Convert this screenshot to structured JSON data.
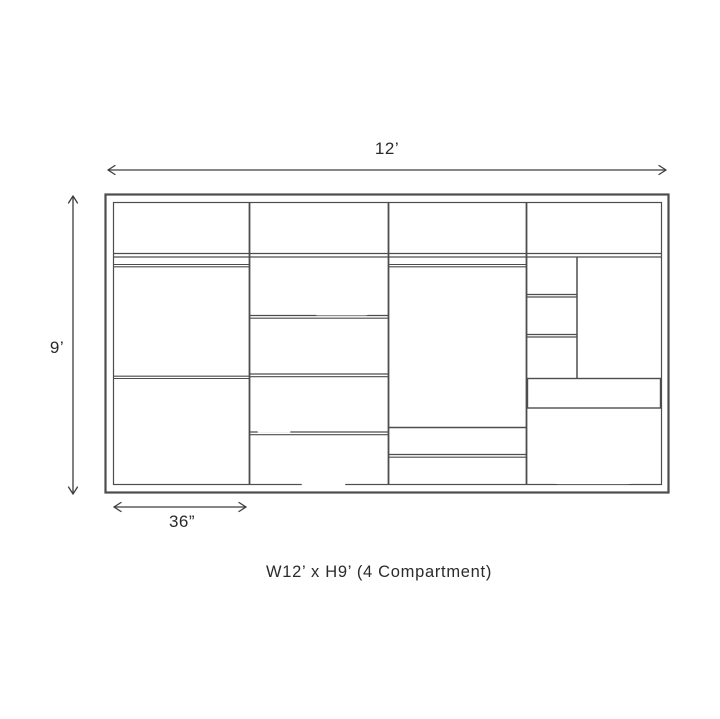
{
  "title": "Wardrobe elevation diagram",
  "dimensions": {
    "width_label": "12’",
    "height_label": "9’",
    "section_width_label": "36”"
  },
  "caption": "W12’ x H9’ (4 Compartment)",
  "colors": {
    "line": "#4d4d4d",
    "dimension_line": "#3d3d3d",
    "text": "#2b2b2b",
    "background": "#ffffff"
  },
  "compartments": [
    {
      "name": "compartment-1",
      "contents": [
        "folded blanket on top shelf",
        "hanging rod with 3 hangers",
        "second hanging rod with 3 hangers"
      ]
    },
    {
      "name": "compartment-2",
      "contents": [
        "large folded blanket on top shelf",
        "two stacks of 3 folded towels",
        "two storage boxes with small folded towel",
        "storage box with small folded towel",
        "two stacked pillows"
      ]
    },
    {
      "name": "compartment-3",
      "contents": [
        "hanging rod with 3 hangers",
        "folded blanket on low shelf"
      ]
    },
    {
      "name": "compartment-4",
      "contents": [
        "top shelf",
        "two cubby shelves beside open niche",
        "drawer",
        "two stacked folded duvets"
      ]
    }
  ]
}
